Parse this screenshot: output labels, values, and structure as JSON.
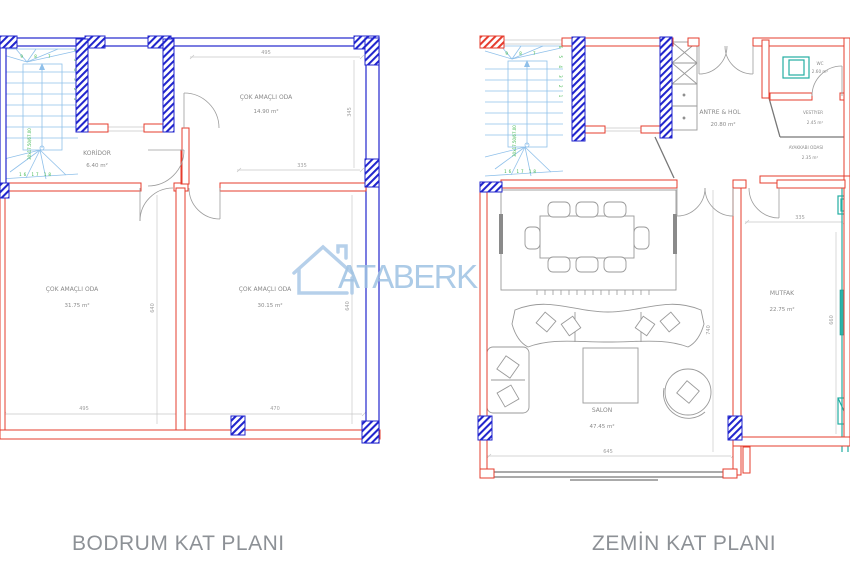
{
  "watermark": {
    "brand": "ATABERK"
  },
  "stairs": {
    "top_numbers": "9 8 7",
    "side_numbers": "6 5 4 3 2 1",
    "bottom_numbers": "16 17 18",
    "note": "30x17.50/67.00"
  },
  "plans": {
    "bodrum": {
      "title": "BODRUM KAT PLANI",
      "rooms": {
        "koridor": {
          "name": "KORİDOR",
          "area": "6.40 m²"
        },
        "oda_ust": {
          "name": "ÇOK AMAÇLI ODA",
          "area": "14.90 m²"
        },
        "oda_sol": {
          "name": "ÇOK AMAÇLI ODA",
          "area": "31.75 m²"
        },
        "oda_sag": {
          "name": "ÇOK AMAÇLI ODA",
          "area": "30.15 m²"
        }
      },
      "dims": {
        "ust": "495",
        "ust_sag": "345",
        "ust_alt": "335",
        "sol_yuk": "640",
        "sag_yuk": "640",
        "alt_sol": "495",
        "alt_sag": "470"
      }
    },
    "zemin": {
      "title": "ZEMİN KAT PLANI",
      "rooms": {
        "antre": {
          "name": "ANTRE & HOL",
          "area": "20.80 m²"
        },
        "vestiyer": {
          "name": "VESTİYER",
          "area": "2.45 m²"
        },
        "ayakkabi": {
          "name": "AYAKKABI ODASI",
          "area": "2.35 m²"
        },
        "wc": {
          "name": "WC",
          "area": "2.60 m²"
        },
        "salon": {
          "name": "SALON",
          "area": "47.45 m²"
        },
        "mutfak": {
          "name": "MUTFAK",
          "area": "22.75 m²"
        }
      },
      "dims": {
        "mutfak_ust": "335",
        "salon_yuk": "740",
        "salon_alt": "645",
        "mutfak_yuk": "660"
      }
    }
  }
}
